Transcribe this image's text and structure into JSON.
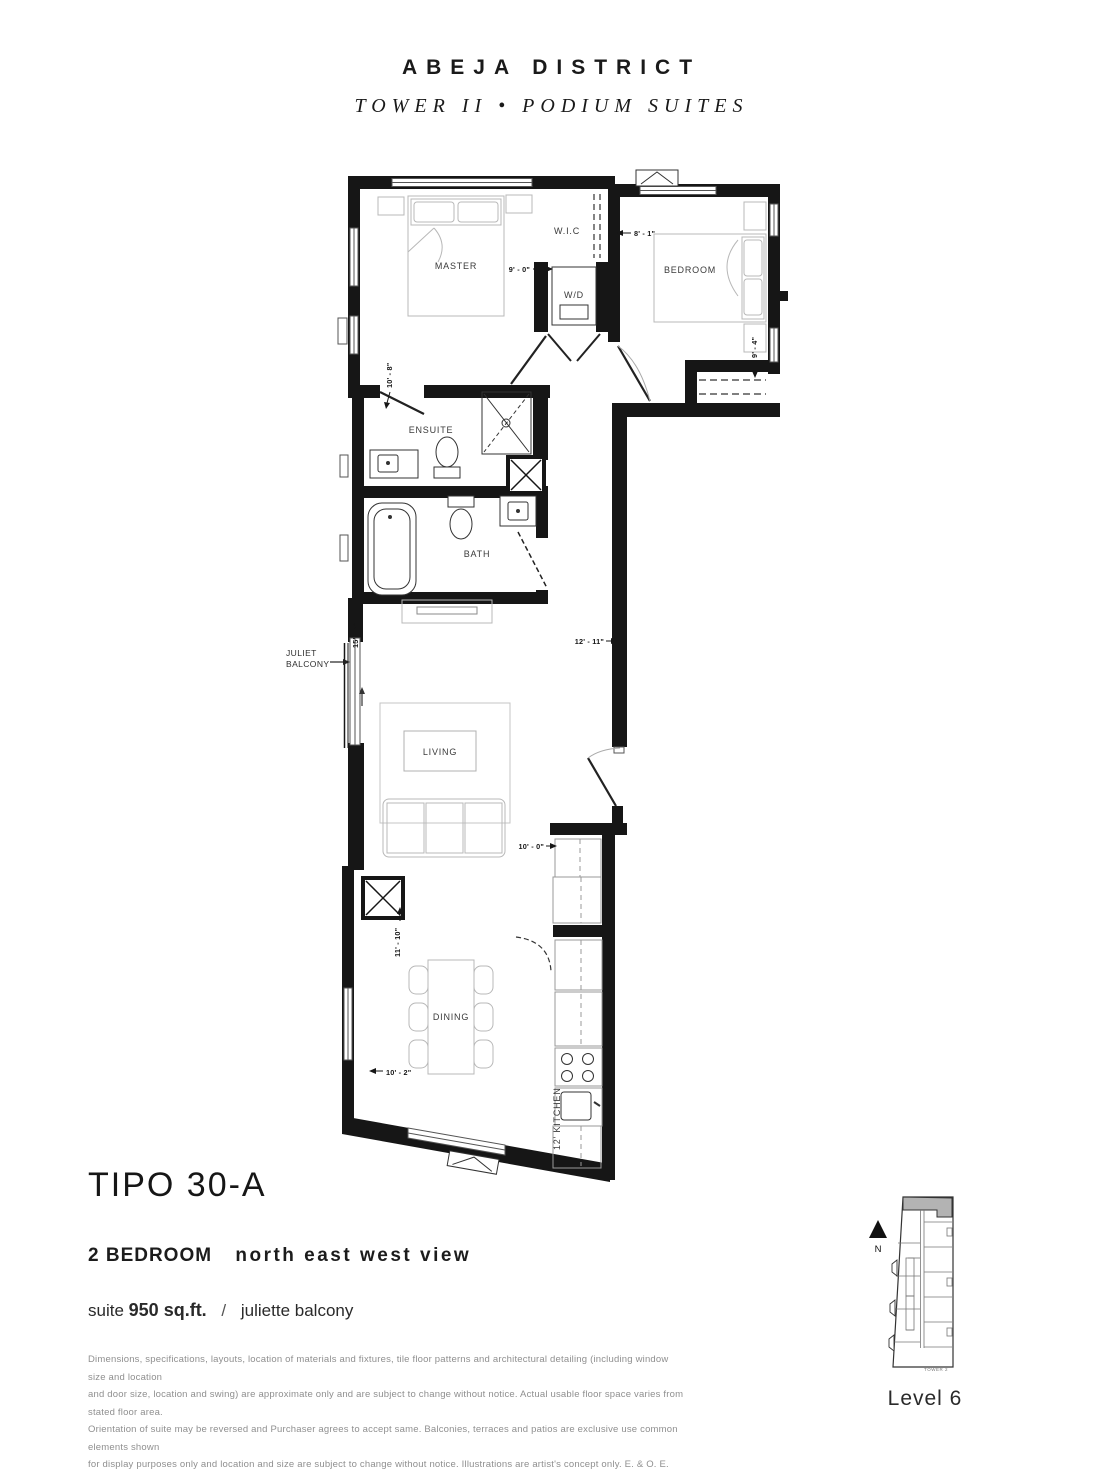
{
  "header": {
    "brand": "ABEJA DISTRICT",
    "subtitle": "TOWER II  •  PODIUM SUITES"
  },
  "floorplan": {
    "rooms": {
      "master": "MASTER",
      "wic": "W.I.C",
      "bedroom": "BEDROOM",
      "wd": "W/D",
      "ensuite": "ENSUITE",
      "bath": "BATH",
      "living": "LIVING",
      "dining": "DINING",
      "kitchen": "12' KITCHEN"
    },
    "callouts": {
      "juliet_line1": "JULIET",
      "juliet_line2": "BALCONY"
    },
    "dimensions": {
      "master_width": "10' - 8\"",
      "wd_width": "9' - 0\"",
      "bedroom_width": "8' - 1\"",
      "bedroom_depth": "9' - 4\"",
      "living_length": "15' - 7\"",
      "living_width": "12' - 11\"",
      "kitchen_width": "10' - 0\"",
      "dining_length": "11' - 10\"",
      "dining_width": "10' - 2\""
    }
  },
  "details": {
    "plan_name": "TIPO 30-A",
    "bedrooms": "2 BEDROOM",
    "view": "north east west view",
    "suite_label": "suite",
    "suite_area": "950 sq.ft.",
    "separator": "/",
    "balcony": "juliette balcony"
  },
  "disclaimer": {
    "lines": [
      "Dimensions, specifications, layouts, location of materials and fixtures, tile floor patterns and architectural detailing (including window size and location",
      "and door size, location and swing) are approximate only and are subject to change without notice. Actual usable floor space varies from stated floor area.",
      "Orientation of suite may be reversed and Purchaser agrees to accept same. Balconies, terraces and patios are exclusive use common elements shown",
      "for display purposes only and location and size are subject to change without notice. Illustrations are artist's concept only. E. & O. E."
    ]
  },
  "keyplan": {
    "north": "N",
    "tower": "TOWER 2",
    "level": "Level 6"
  }
}
